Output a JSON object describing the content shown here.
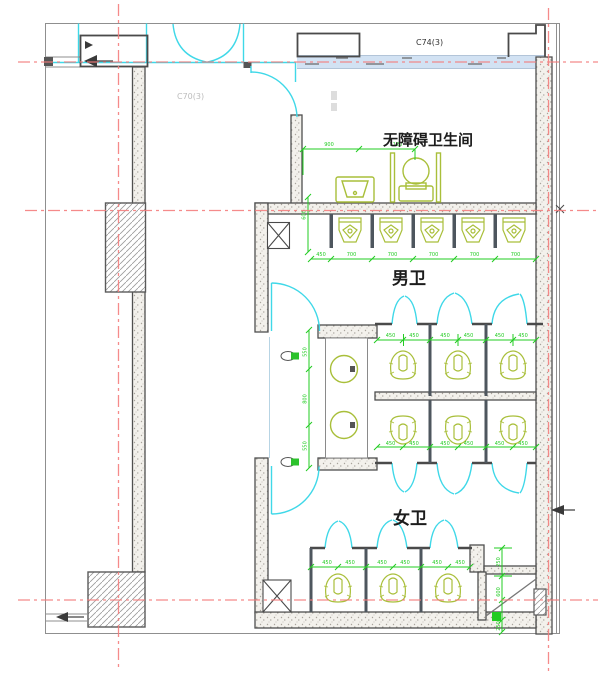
{
  "labels": {
    "accessible_restroom": "无障碍卫生间",
    "mens_restroom": "男卫",
    "womens_restroom": "女卫",
    "window_tag_top": "C74(3)",
    "window_tag_left": "C70(3)"
  },
  "dims": {
    "accessible": [
      "900",
      "1120"
    ],
    "side": [
      "600"
    ],
    "urinals": [
      "450",
      "700",
      "700",
      "700",
      "700",
      "700"
    ],
    "mens_upper": [
      "450",
      "450",
      "450",
      "450",
      "450",
      "450"
    ],
    "mens_lower": [
      "450",
      "450",
      "450",
      "450",
      "450",
      "450"
    ],
    "womens": [
      "450",
      "450",
      "450",
      "450",
      "450",
      "450"
    ],
    "vanity": [
      "550",
      "800",
      "550"
    ],
    "shaft": [
      "250",
      "600",
      "250"
    ]
  },
  "fixtures": {
    "urinal_count": 5,
    "mens_toilet_stalls": 6,
    "womens_toilet_stalls": 3,
    "vanity_sinks": 2,
    "accessible_fixtures": [
      "sink",
      "toilet"
    ]
  },
  "colors": {
    "centerline": "#f47b7b",
    "door": "#3fd8e8",
    "fixture": "#a9bf3a",
    "dimension": "#22cc22",
    "wall": "#4f4f4f",
    "window_band": "#cddff2"
  }
}
